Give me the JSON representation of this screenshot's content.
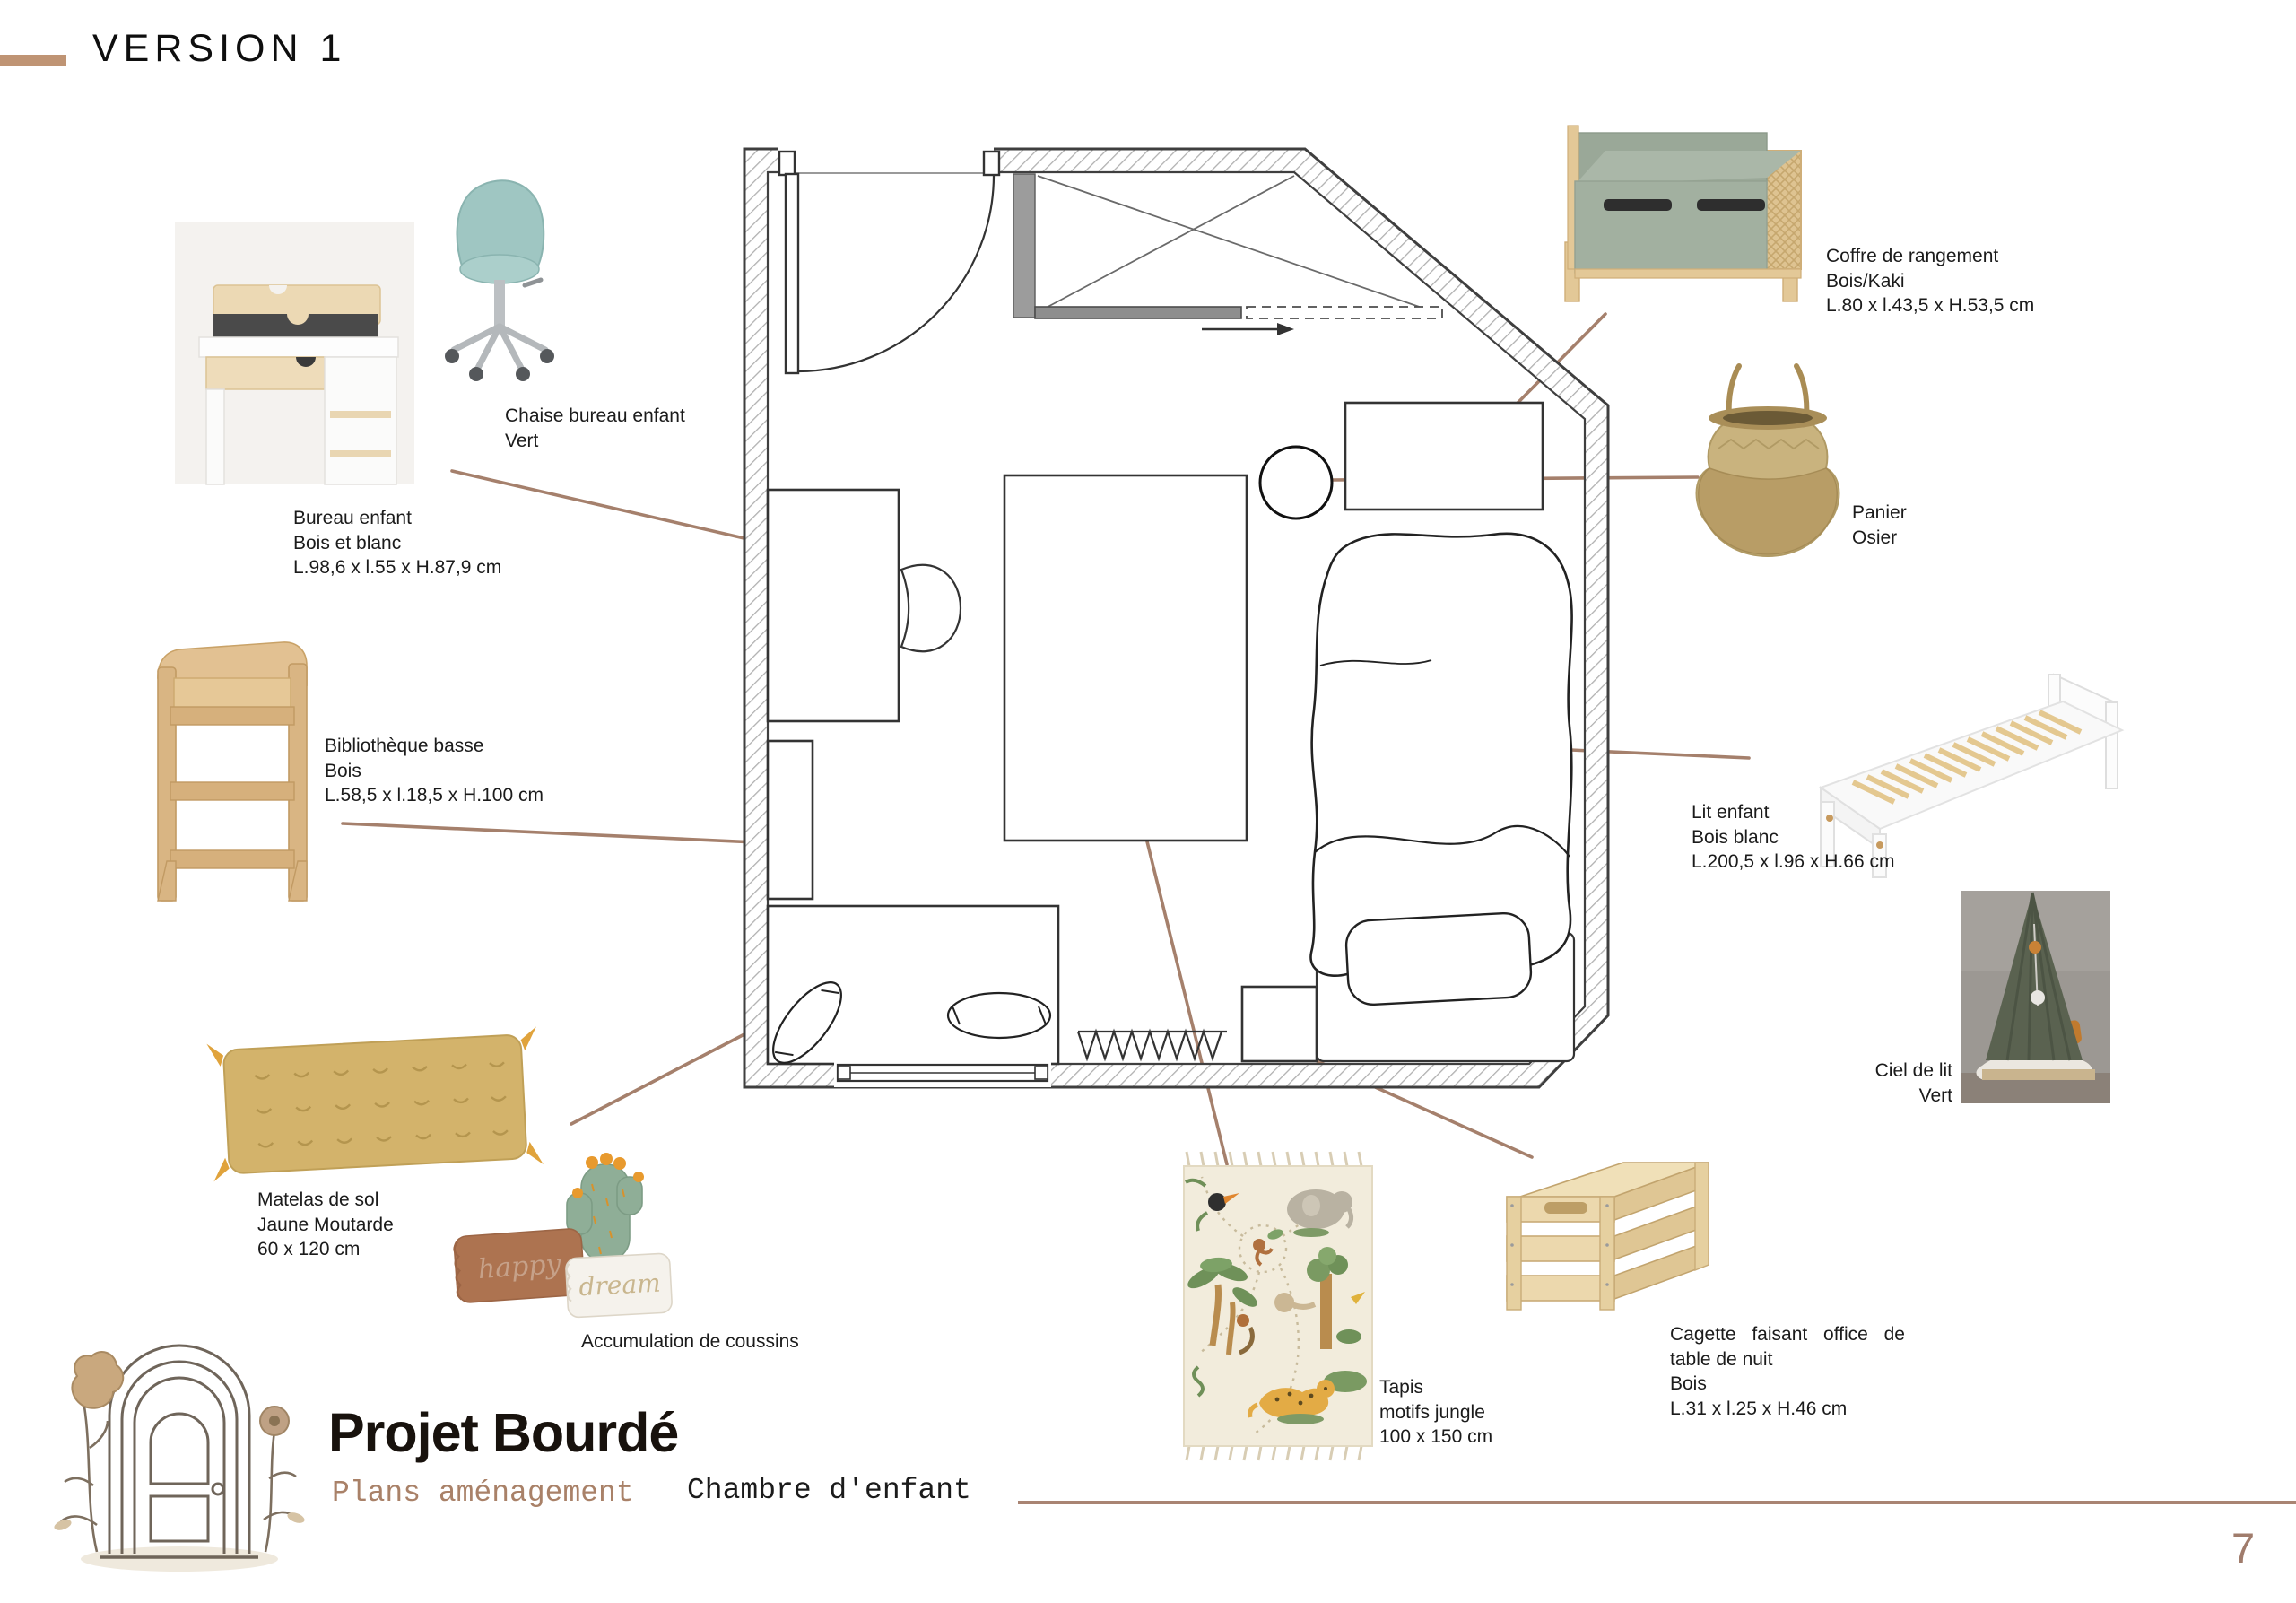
{
  "page": {
    "title": "VERSION 1",
    "number": "7"
  },
  "footer": {
    "brand": "Projet Bourdé",
    "subtitle": "Plans aménagement",
    "section": "Chambre d'enfant"
  },
  "labels": {
    "chaise": {
      "lines": [
        "Chaise bureau enfant",
        "Vert"
      ]
    },
    "bureau": {
      "lines": [
        "Bureau enfant",
        "Bois et blanc",
        "L.98,6 x l.55 x H.87,9 cm"
      ]
    },
    "coffre": {
      "lines": [
        "Coffre de rangement",
        "Bois/Kaki",
        "L.80 x l.43,5 x H.53,5 cm"
      ]
    },
    "panier": {
      "lines": [
        "Panier",
        "Osier"
      ]
    },
    "biblio": {
      "lines": [
        "Bibliothèque basse",
        "Bois",
        "L.58,5 x l.18,5 x H.100 cm"
      ]
    },
    "lit": {
      "lines": [
        "Lit enfant",
        "Bois blanc",
        "L.200,5 x l.96 x H.66 cm"
      ]
    },
    "ciel": {
      "lines": [
        "Ciel de lit",
        "Vert"
      ]
    },
    "matelas": {
      "lines": [
        "Matelas de sol",
        "Jaune Moutarde",
        "60 x 120 cm"
      ]
    },
    "coussins": {
      "lines": [
        "Accumulation de coussins"
      ]
    },
    "tapis": {
      "lines": [
        "Tapis",
        "motifs jungle",
        "100 x 150 cm"
      ]
    },
    "cagette": {
      "lines": [
        "Cagette faisant office de",
        "table de nuit",
        "Bois",
        "L.31 x l.25 x H.46 cm"
      ]
    }
  },
  "illustrations": {
    "happy_text": "happy",
    "dream_text": "dream"
  },
  "colors": {
    "accent_brown": "#a5806c",
    "bar_tan": "#bf9474",
    "kaki": "#a2b0a0",
    "teal_chair": "#9fc6c2",
    "mustard": "#d3b36b",
    "wood": "#dcb888",
    "canopy_green": "#5a6250"
  }
}
